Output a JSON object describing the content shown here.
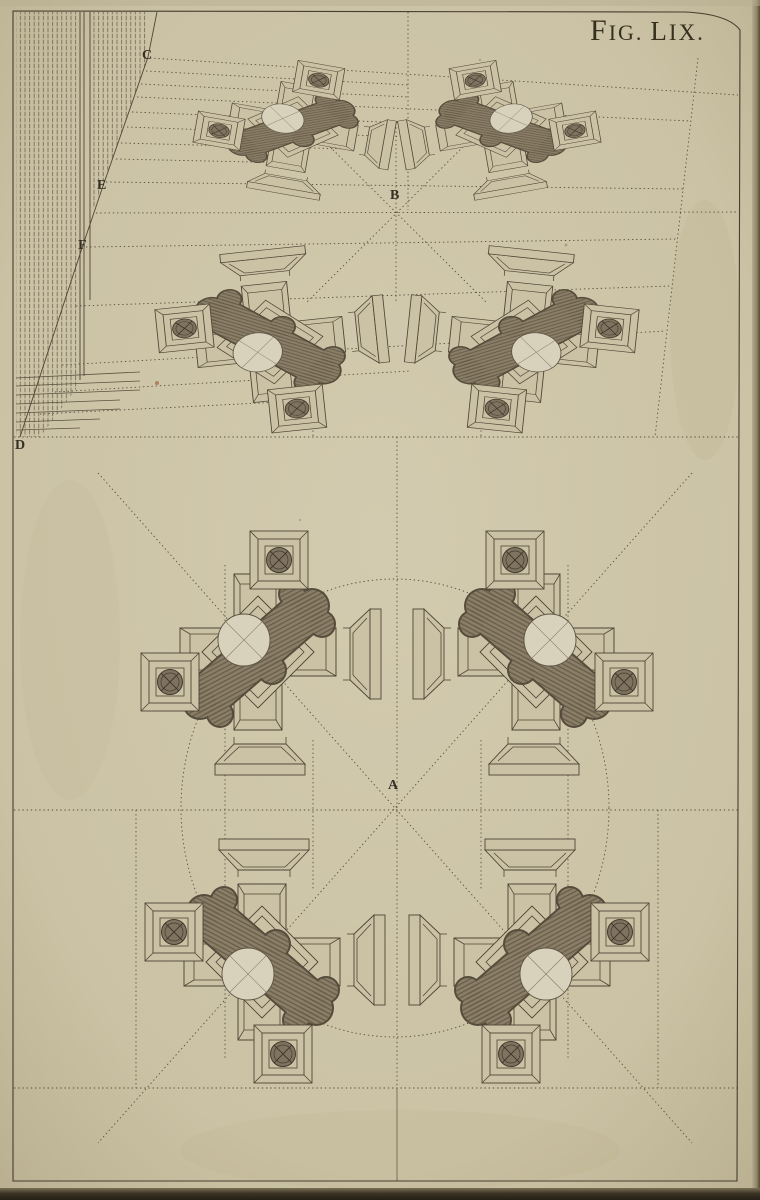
{
  "figure": {
    "label_parts": {
      "f1": "F",
      "f2": "IG.",
      "f3": "L",
      "f4": "IX."
    },
    "reference_points": {
      "A": "A",
      "B": "B",
      "C": "C",
      "D": "D",
      "E": "E",
      "F": "F"
    }
  },
  "drawing": {
    "pier_cluster_count": 8,
    "zones": {
      "upper": "perspective view toward point B",
      "lower": "plan grid around point A"
    }
  },
  "palette": {
    "paper": "#cbc2a5",
    "ink": "#4e4536",
    "pier_shade": "#8a7e68",
    "column_section": "#7f7360",
    "page_edge_dark": "#241f16"
  }
}
